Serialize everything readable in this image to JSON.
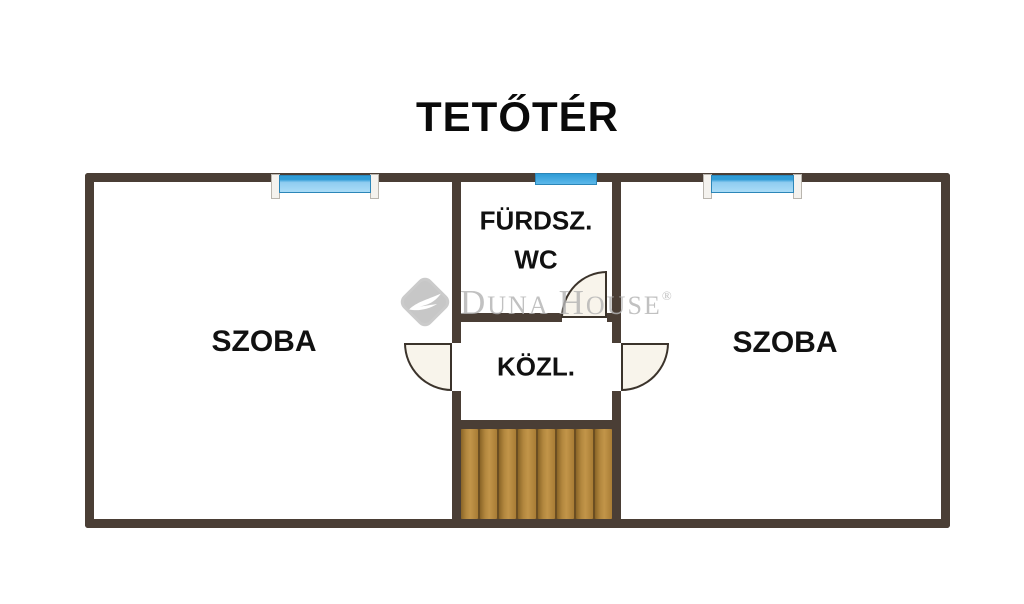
{
  "title": "TETŐTÉR",
  "floorplan": {
    "rooms": {
      "left_room": {
        "label": "SZOBA"
      },
      "right_room": {
        "label": "SZOBA"
      },
      "bathroom": {
        "label_line1": "FÜRDSZ.",
        "label_line2": "WC"
      },
      "hallway": {
        "label": "KÖZL."
      }
    },
    "features": {
      "windows": [
        "left-window",
        "middle-window",
        "right-window"
      ],
      "doors": [
        "left-room-door",
        "right-room-door",
        "bathroom-door"
      ],
      "stairs": {
        "step_count": 8
      }
    },
    "colors": {
      "wall": "#4a3e35",
      "window_glass_top": "#2f9cd6",
      "window_glass": "#8fccf0",
      "door_leaf": "#f8f4eb",
      "door_outline": "#3b332b",
      "stair_wood": "#b2873e",
      "stair_gap": "#6b4e22",
      "label_text": "#111111",
      "watermark_gray": "#b4b4b4"
    }
  },
  "watermark": {
    "logo": "duna-house-diamond-logo",
    "word1_initial": "D",
    "word1_rest": "UNA",
    "word2_initial": "H",
    "word2_rest": "OUSE",
    "registered": "®"
  }
}
